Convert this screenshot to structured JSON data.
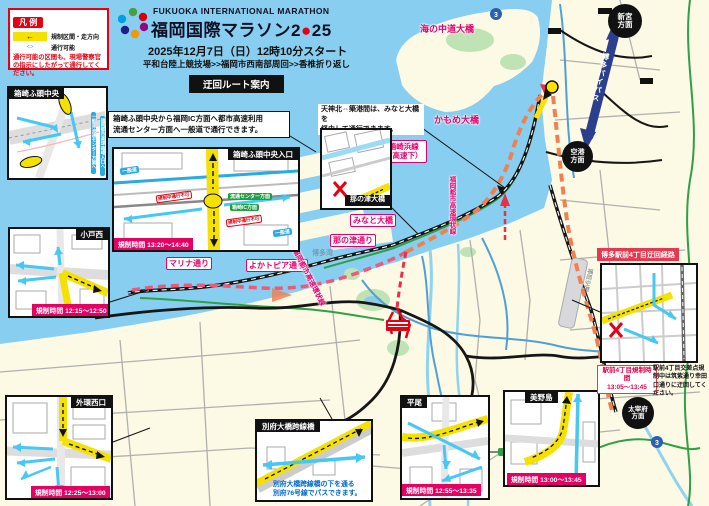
{
  "colors": {
    "brand_red": "#E60012",
    "magenta": "#E5006E",
    "restriction_bar": "#E50064",
    "route_orange": "#F08050",
    "route_pink": "#F05878",
    "water": "#87CEF0",
    "land": "#FCF9E4",
    "road_yellow": "#F5E100",
    "bypass_blue": "#2B3F8C"
  },
  "header": {
    "logo_en": "FUKUOKA INTERNATIONAL MARATHON",
    "title_a": "福岡国際マラソン2",
    "title_dot": "●",
    "title_b": "25",
    "date_line": "2025年12月7日（日）12時10分スタート",
    "course_line": "平和台陸上競技場>>福岡市西南部周回>>香椎折り返し",
    "banner": "迂回ルート案内"
  },
  "legend": {
    "title": "凡 例",
    "restricted_arrow": "←",
    "restricted": "規制区間・走方向",
    "passable_arrow": "⇔",
    "passable": "通行可能",
    "note": "通行可能の区間も、現場警察官の指示にしたがって通行してください。"
  },
  "notes": {
    "hakozaki_1": "箱崎ふ頭中央から福岡IC方面へ都市高速利用",
    "hakozaki_2": "流通センター方面へ一般道で通行できます。",
    "tenjin_1": "天神北⇔築港間は、みなと大橋を",
    "tenjin_2": "経由して通行できます。",
    "beppu_1": "別府大橋跨線橋の下を通る",
    "beppu_2": "別府76号線でパスできます。",
    "ekimae_title": "博多駅前4丁目迂回経路",
    "ekimae_time_1": "駅前4丁目規制時間",
    "ekimae_time_2": "13:05～13:45",
    "ekimae_note": "駅前4丁目交差点規制中は筑紫通り幸田口通りに迂回してください。"
  },
  "insets": {
    "hakozaki_chuo": {
      "title": "箱崎ふ頭中央",
      "side_a": "一般道 流通センター方面へ",
      "side_b": "福岡都市高速 箱崎入口へ"
    },
    "odo_nishi": {
      "title": "小戸西",
      "time": "規制時間 12:15～12:50"
    },
    "hakozaki_in": {
      "title": "箱崎ふ頭中央入口",
      "time": "規制時間 13:20～14:40",
      "chip_ippan": "一般道",
      "chip_kisei": "規制中通行不可",
      "chip_ryutsu": "流通センター方面",
      "chip_ic": "箱崎IC方面"
    },
    "nanotsu": {
      "title": "那の津大橋"
    },
    "gaikan": {
      "title": "外環西口",
      "time": "規制時間 12:25～13:00"
    },
    "beppu": {
      "title": "別府大橋跨線橋"
    },
    "hirao": {
      "title": "平尾",
      "time": "規制時間 12:55～13:35"
    },
    "minoshima": {
      "title": "美野島",
      "time": "規制時間 13:00～13:45"
    }
  },
  "map_labels": {
    "umi_no_nakamichi": "海の中道大橋",
    "kamome": "かもめ大橋",
    "kashii_1": "香椎箱崎浜線",
    "kashii_2": "（都市高速下）",
    "minato": "みなと大橋",
    "nanotsu_dori": "那の津通り",
    "marina": "マリナ通り",
    "yokatopia": "よかトピア通り",
    "loop_line": "福岡都市高速環状線",
    "hakata_bay": "博多湾",
    "bypass": "博多バイパス",
    "shingu_1": "新宮",
    "shingu_2": "方面",
    "kuko_1": "空港",
    "kuko_2": "方面",
    "dazaifu_1": "太宰府",
    "dazaifu_2": "方面",
    "airport": "福岡空港",
    "route3": "3"
  }
}
